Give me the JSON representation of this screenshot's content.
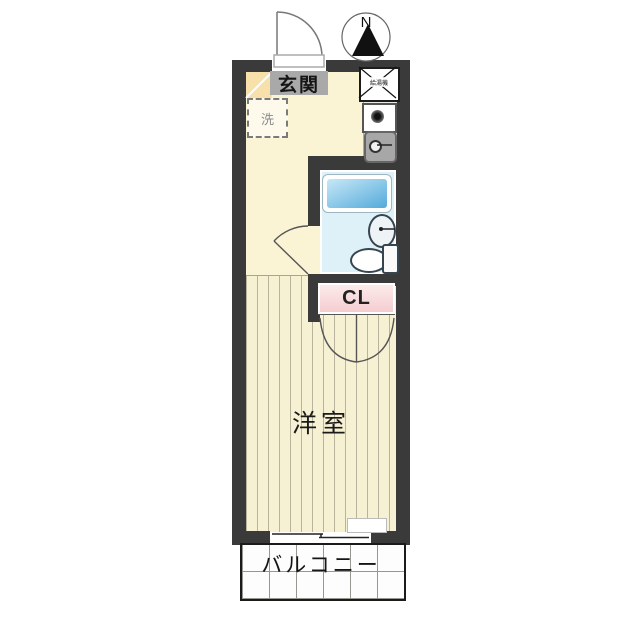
{
  "title": "apartment-floor-plan",
  "compass": {
    "north_label": "N"
  },
  "rooms": {
    "entrance": {
      "label": "玄関"
    },
    "washer": {
      "label": "洗"
    },
    "water_heater": {
      "label": "給湯機"
    },
    "closet": {
      "label": "CL"
    },
    "western_room": {
      "label": "洋室"
    },
    "balcony": {
      "label": "バルコニー"
    }
  },
  "colors": {
    "wall": "#3a3a3a",
    "floor-hall": "#faf3d4",
    "floor-room": "#f7f1d4",
    "stripe": "#b9b29c",
    "genkan-tile": "#f7e0aa",
    "label-gray": "#a9a9a9",
    "counter": "#ebe9e0",
    "bath-floor": "#dff1f8",
    "tub-light": "#c7e8f7",
    "tub-dark": "#54aadb",
    "cl-light": "#fcebe9",
    "cl-dark": "#f5cdd1"
  }
}
